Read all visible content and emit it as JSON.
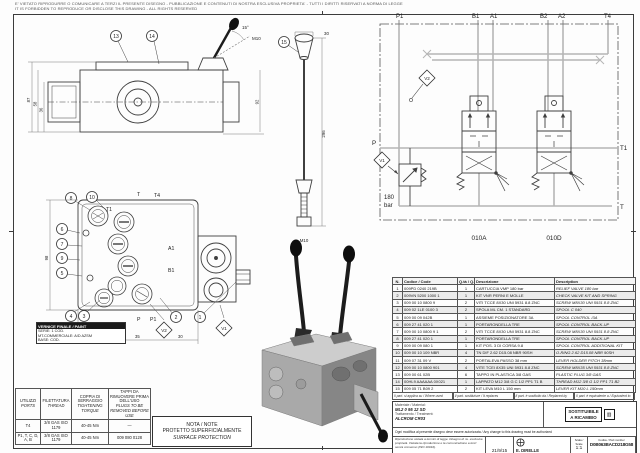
{
  "page": {
    "disclaimer1": "E' VIETATO RIPRODURRE O COMUNICARE A TERZI IL PRESENTE DISEGNO - PUBBLICAZIONE E CONTENUTI DI NOSTRA ESCLUSIVA PROPRIETA' - TUTTI I DIRITTI RISERVATI A NORMA DI LEGGE",
    "disclaimer2": "IT IS FORBIDDEN TO REPRODUCE OR DISCLOSE THIS DRAWING - ALL RIGHTS RESERVED"
  },
  "schematic": {
    "port_p1": "P1",
    "port_b1": "B1",
    "port_a1": "A1",
    "port_b2": "B2",
    "port_a2": "A2",
    "port_t4": "T4",
    "port_p": "P",
    "port_t1": "T1",
    "port_t": "T",
    "tag_v1": "V1",
    "tag_v2": "V2",
    "relief_value": "180",
    "relief_unit": "bar",
    "section_a": "010A",
    "section_b": "010D"
  },
  "front_view": {
    "balloons": [
      "8",
      "10",
      "6",
      "7",
      "9",
      "5",
      "4",
      "3",
      "2",
      "1"
    ],
    "port_t1": "T1",
    "port_t": "T",
    "port_t4": "T4",
    "port_p": "P",
    "port_p1": "P1",
    "port_a1": "A1",
    "port_b1": "B1",
    "tag_v1": "V1",
    "tag_v2": "V2",
    "dims": [
      "28",
      "35",
      "30",
      "98"
    ],
    "paint_box": {
      "title": "VERNICE FINALE / PAINT",
      "line1": "SERIE: 1 COD.",
      "line2": "MT.COMMERCIALE: A/D AZSM",
      "line3": "BASE: COD."
    }
  },
  "side_view": {
    "balloon_13": "13",
    "balloon_14": "14",
    "dims": [
      "87",
      "58",
      "36",
      "92"
    ],
    "angle": "15°",
    "thread": "M10"
  },
  "detail_view": {
    "balloon_15": "15",
    "dim_len": "296",
    "dim_top": "30",
    "thread": "M10"
  },
  "torque_table": {
    "headers": [
      {
        "it": "UTILIZZI",
        "en": "PORTS"
      },
      {
        "it": "FILETTATURA",
        "en": "THREAD"
      },
      {
        "it": "COPPIA DI SERRAGGIO",
        "en": "TIGHTENING TORQUE"
      },
      {
        "it": "TAPPI DA RIMUOVERE PRIMA DELL'USO",
        "en": "PLUGS TO BE REMOVED BEFORE USE"
      }
    ],
    "rows": [
      [
        "T4",
        "3/8 GAS ISO 1179",
        "40-45 Nm",
        "—"
      ],
      [
        "P1, T, C, D, A, B",
        "3/8 GAS ISO 1179",
        "40-45 Nm",
        "009 080 0128"
      ]
    ]
  },
  "note_box": {
    "title": "NOTA / NOTE",
    "line_it": "PROTETTO SUPERFICIALMENTE",
    "line_en": "SURFACE PROTECTION"
  },
  "parts_table": {
    "headers": {
      "n": "N.",
      "code": "Codice / Code",
      "qty": "Q.tà / Q.ty",
      "desc_it": "Descrizione",
      "desc_en": "Description"
    },
    "rows": [
      {
        "n": "1",
        "code": "009PD 0240 219B",
        "qty": "1",
        "it": "CARTUCCIA VMP 180 bar",
        "en": "RELIEF VALVE 180 bar"
      },
      {
        "n": "2",
        "code": "009VN 5200 1000 1",
        "qty": "1",
        "it": "KIT VNR PERNI E MOLLE",
        "en": "CHECK VALVE KIT AND SPRING"
      },
      {
        "n": "3",
        "code": "009 00 10 0800 9",
        "qty": "2",
        "it": "VITI TCCE 8X30 UNI 5931 8.8 ZNC",
        "en": "SCREW M8X30 UNI 5931 8.8 ZNC"
      },
      {
        "n": "4",
        "code": "009 02 1LE 0100 3",
        "qty": "2",
        "it": "SPOLA ML CM. 1 STANDARD",
        "en": "SPOOL C 040"
      },
      {
        "n": "5",
        "code": "009 00 09 042B",
        "qty": "1",
        "it": "ASSIEME POSIZIONATORE 3A",
        "en": "SPOOL CONTROL /3A"
      },
      {
        "n": "6",
        "code": "009 27 41 020 1",
        "qty": "1",
        "it": "PORTARONDELLA TRE",
        "en": "SPOOL CONTROL BACK-UP"
      },
      {
        "n": "7",
        "code": "009 00 10 0800 9 1",
        "qty": "2",
        "it": "VITI TCCE 8X30 UNI 5931 8.8 ZNC",
        "en": "SCREW M8X30 UNI 5931 8.8 ZNC"
      },
      {
        "n": "8",
        "code": "009 27 41 020 1",
        "qty": "1",
        "it": "PORTARONDELLA TRE",
        "en": "SPOOL CONTROL BACK-UP"
      },
      {
        "n": "9",
        "code": "009 00 09 080 1",
        "qty": "1",
        "it": "KIT POS. 3 DI CORSA 9.8",
        "en": "SPOOL CONTROL ADDITIONAL KIT"
      },
      {
        "n": "10",
        "code": "009 00 10 109 NBR",
        "qty": "4",
        "it": "TN DIF 2.62 D15.08 NBR 90SH",
        "en": "O-RING 2.62 D15.08 NBR 90SH"
      },
      {
        "n": "11",
        "code": "009 07 31 09 V",
        "qty": "2",
        "it": "PORTALEVA PASSO 38 mm",
        "en": "LEVER HOLDER PITCH 38mm"
      },
      {
        "n": "12",
        "code": "009 00 10 0800 901",
        "qty": "4",
        "it": "VITE TCEI 8X35 UNI 5931 8.8 ZNC",
        "en": "SCREW M8X35 UNI 5931 8.8 ZNC"
      },
      {
        "n": "13",
        "code": "009 00 61 02B",
        "qty": "6",
        "it": "TAPPO IN PLASTICA 3/8 GAS",
        "en": "PLASTIC PLUG 3/8 GAS"
      },
      {
        "n": "14",
        "code": "00HL9 AAAAAA 0X021",
        "qty": "1",
        "it": "LAPPATO M12 3/8 G C 1/2 PP1 T1 B",
        "en": "THREAD M12 3/8 G 1/2 PP1 T1 B2"
      },
      {
        "n": "15",
        "code": "009 05 71 B09 2",
        "qty": "2",
        "it": "KIT LEVA M10 L 150 mm",
        "en": "LEVER KIT M10 L 150mm"
      }
    ],
    "footers": [
      "Il part. si applica su / Where used",
      "Il part. sostituisce / It replaces",
      "Il part. è sostituito da / Replaced by",
      "Il part. è equivalente a / Equivalent to"
    ]
  },
  "title_block": {
    "material_label": "Materiale / Material:",
    "material_value": "ML2 0 95 12 SD",
    "treatment_label": "Trattamento / Treatment:",
    "treatment_value": "ALCROM CR03",
    "mod_row": "Ogni modifica al presente disegno deve essere autorizzata / Any change to this drawing must be authorized",
    "stamp_line1": "SOSTITUIBILE",
    "stamp_line2": "A RICAMBIO",
    "property_note": "Riproduzione vietata a termini di legge. Disegno di ns. esclusiva proprietà. Vietata la riproduzione e la comunicazione a terzi senza consenso (ISO 16016).",
    "date1": "21/9/15",
    "drawn_label": "Disegnatore / Draftsman",
    "drawn_value": "E. DIRELLE",
    "check_label": "Data / Date",
    "check_date": "17/10/2011",
    "scale_label": "Scala / Scale",
    "scale_value": "1:1",
    "code_label": "Codice / Part number",
    "code_value": "D0B063BACD218G58",
    "rev_label": "Rev.",
    "rev_value": "0",
    "footer_left": "Sost. il disegno / Replaces drawing",
    "footer_right": "Sost. dal disegno / Replaced by drawing"
  }
}
